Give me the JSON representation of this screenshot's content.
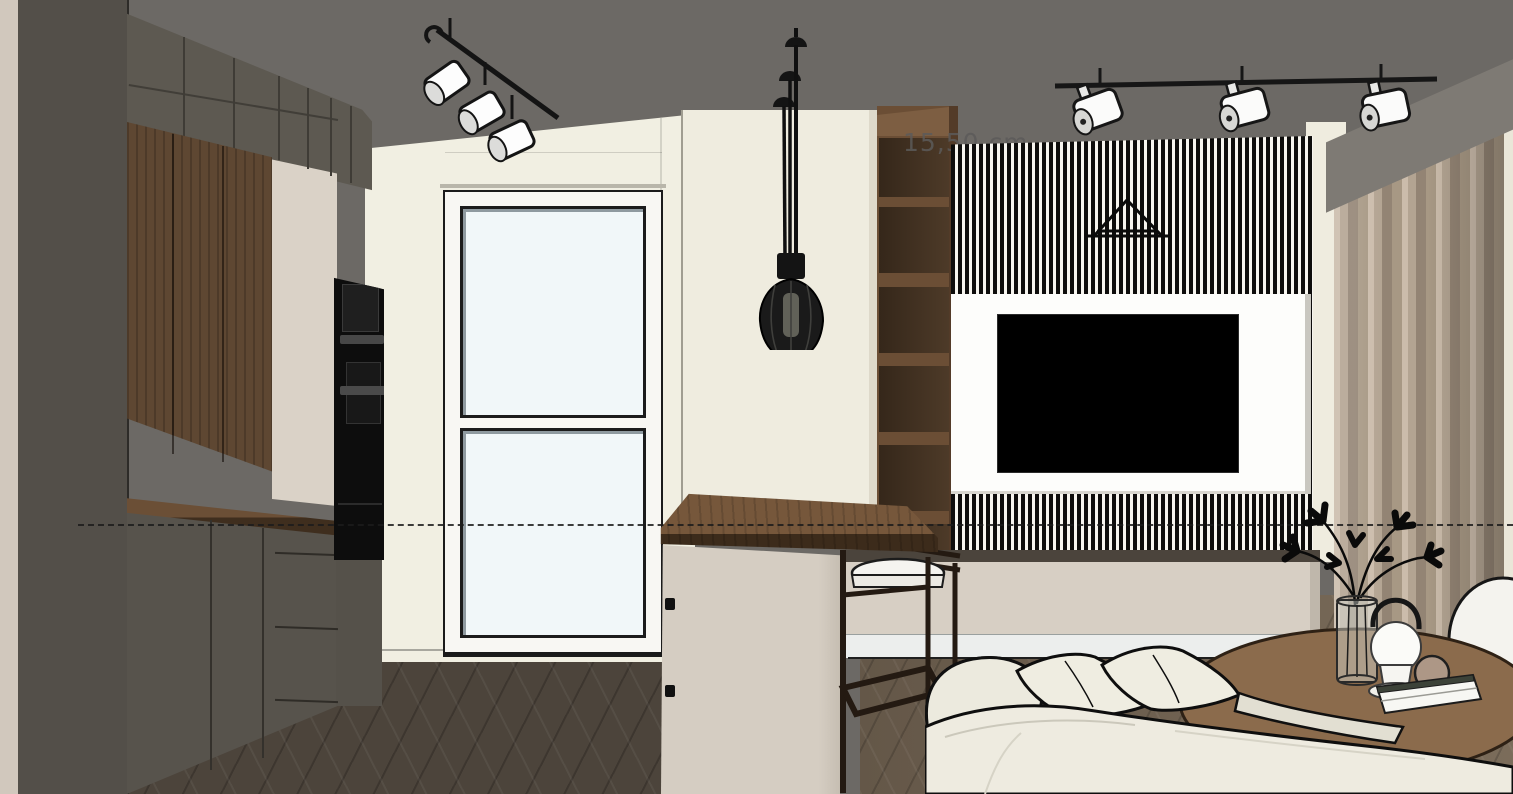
{
  "viewport": {
    "type": "3d-interior-render",
    "dimension_annotation": "15,50 cm",
    "objects": [
      "ceiling",
      "left track spotlights",
      "right track spotlights",
      "industrial pendant lamp",
      "tall dark kitchen cabinets",
      "walnut cabinet doors",
      "built-in ovens",
      "kitchen countertop",
      "glazed door",
      "kitchen island with bar top",
      "bar stool",
      "open walnut shelving",
      "vertical slat wall",
      "tv panel",
      "tv screen",
      "triangle wall decor",
      "media console",
      "soffit",
      "curtain",
      "sofa with pillows",
      "round coffee table",
      "glass vase with branches",
      "portable mushroom lamp",
      "decor sphere",
      "books",
      "white pouf",
      "herringbone wood floor",
      "dashed section line"
    ]
  },
  "palette": {
    "ceiling": "#6c6965",
    "wall_cream": "#f1efe2",
    "left_wall_strip": "#d1c8bd",
    "cabinet_dark": "#57534c",
    "cabinet_upper": "#5d5951",
    "wood_walnut": "#5e4732",
    "appliance_black": "#0d0d0d",
    "niche_beige": "#dad2c7",
    "slat_black": "#0e0d0c",
    "slat_white": "#f7f5ef",
    "tv_black": "#000000",
    "tv_panel_white": "#fdfdfb",
    "console_beige": "#d7cfc4",
    "plinth_white": "#eceeed",
    "island_cream": "#efecdf",
    "island_base": "#d5cdc2",
    "bar_wood": "#76573b",
    "stool_frame": "#241a12",
    "floor_kitchen": "#4c443b",
    "floor_living": "#6f6253",
    "curtain_taupe": "#a89a88",
    "soffit_gray": "#7e7a74",
    "sofa_cream": "#eeebe0",
    "table_wood": "#8b6b4c",
    "glass": "#f1f7f9"
  }
}
